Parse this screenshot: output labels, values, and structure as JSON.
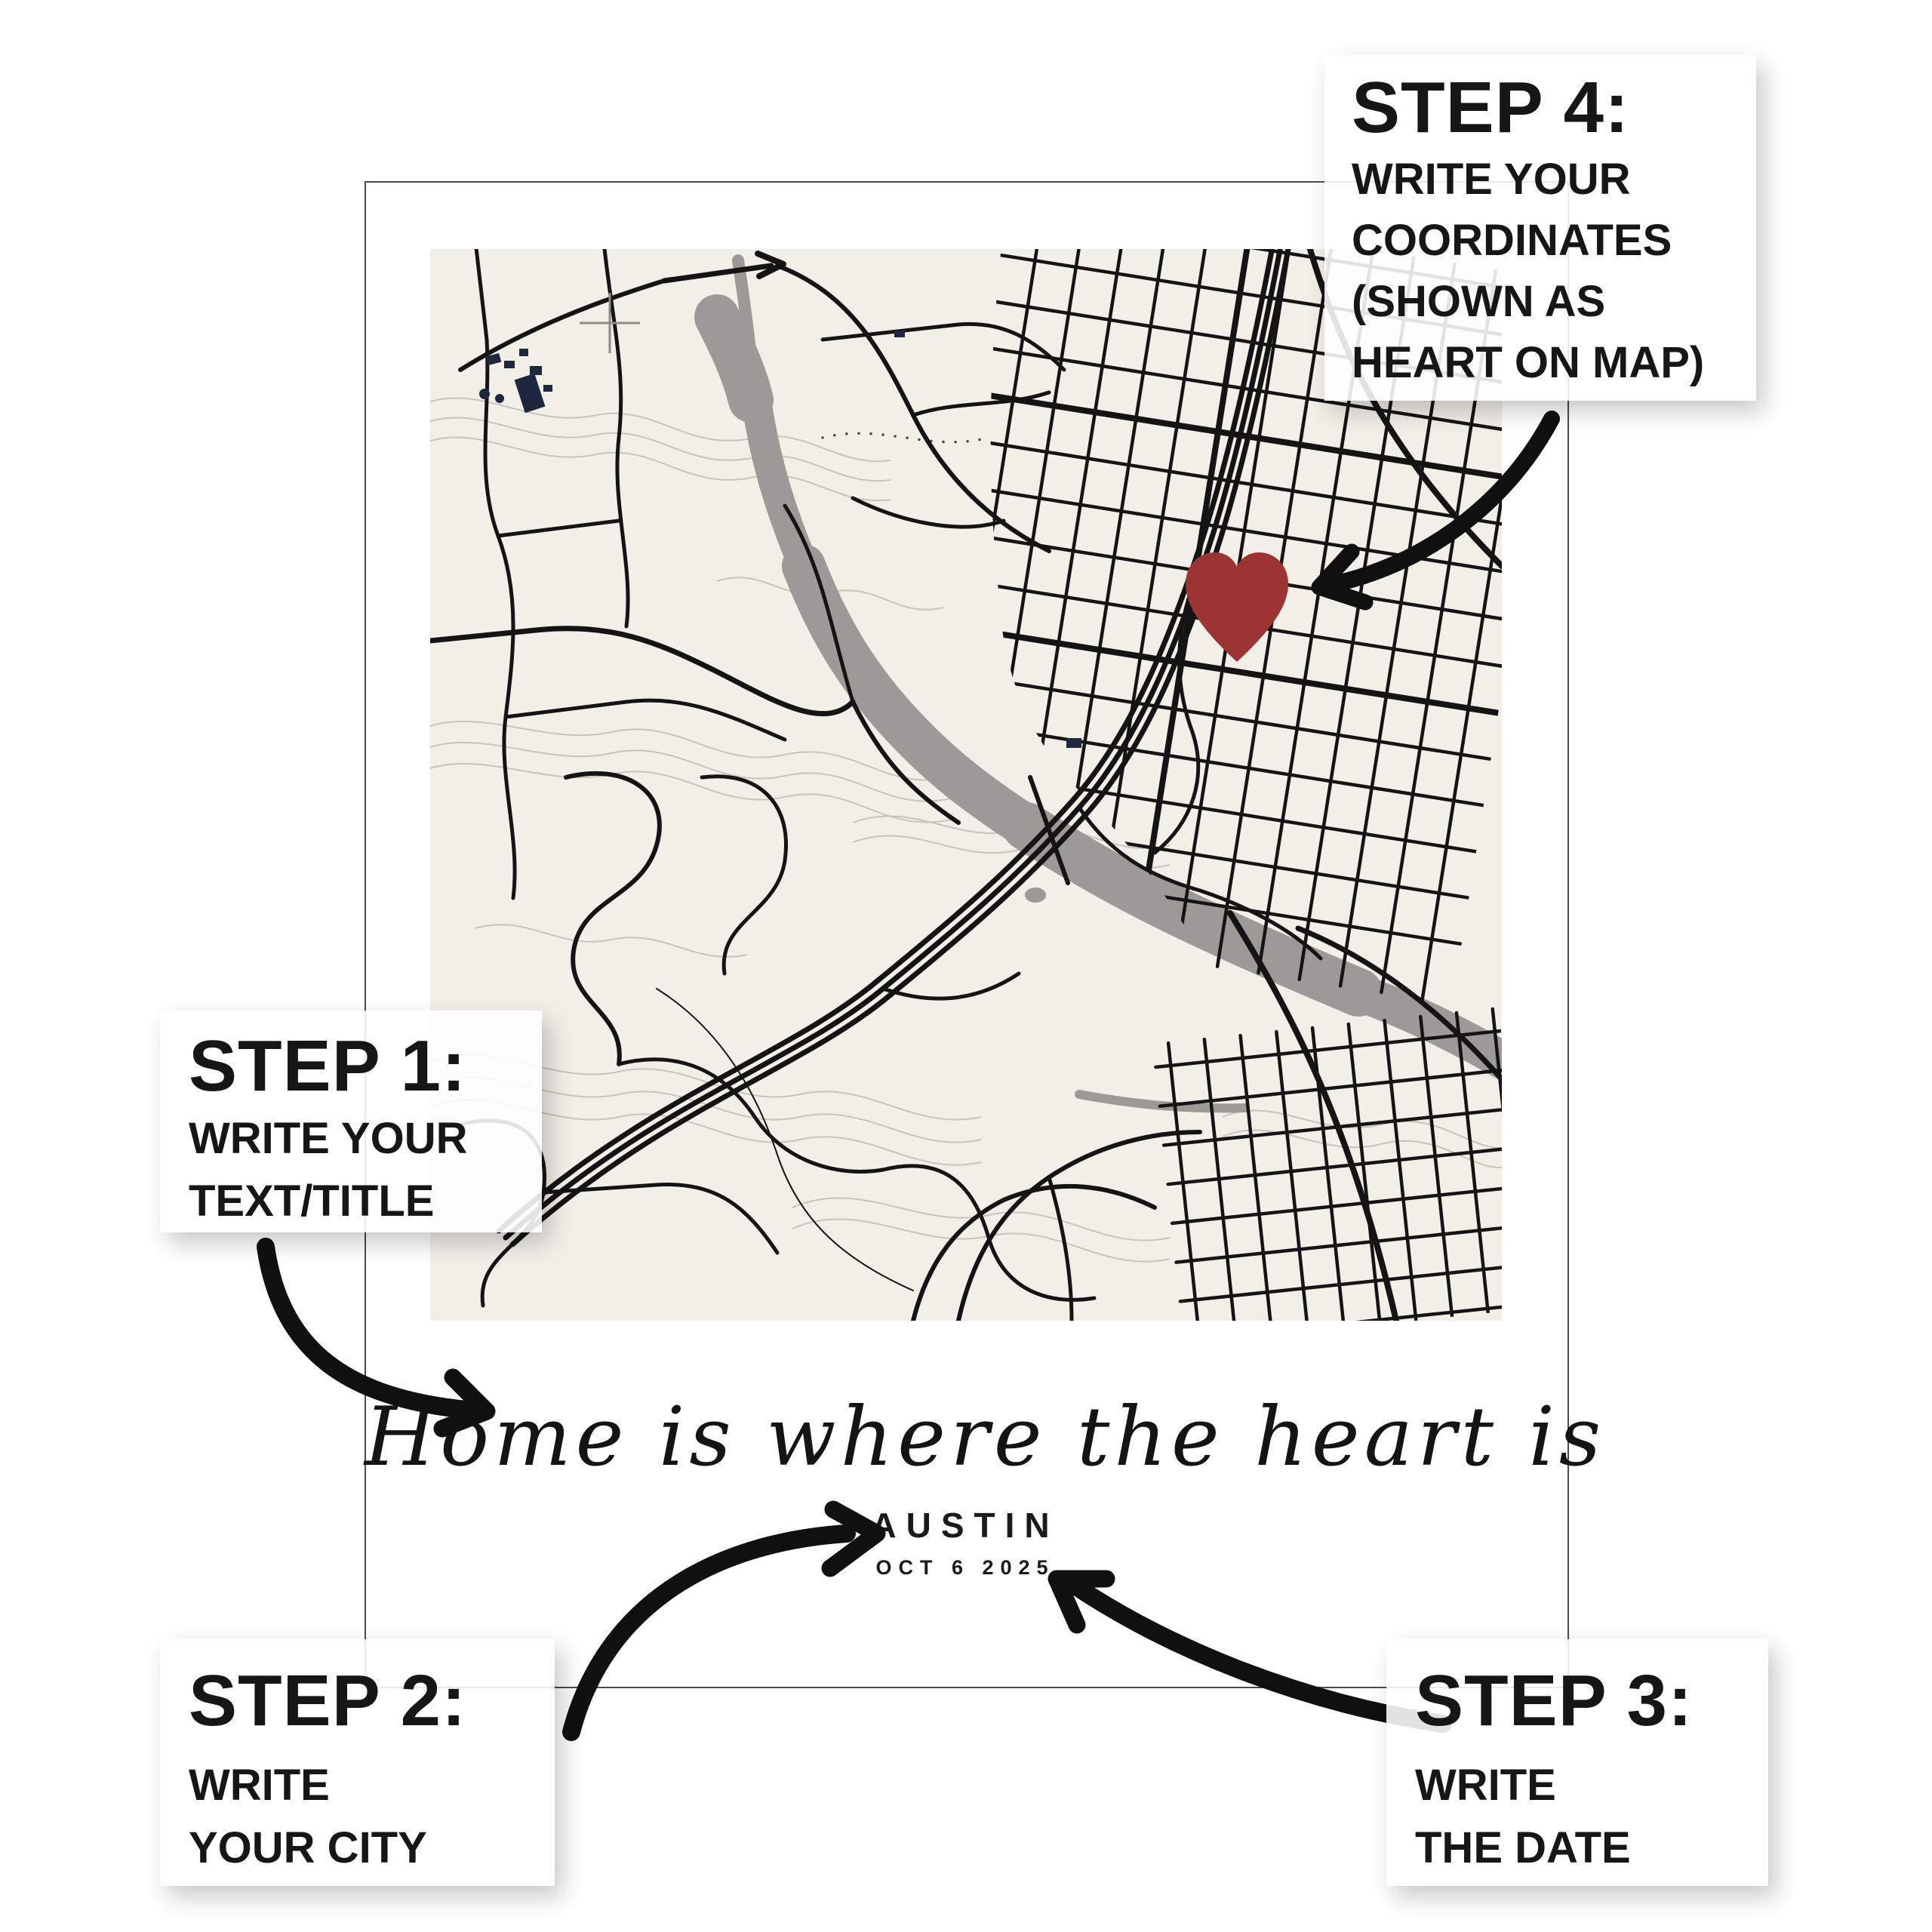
{
  "poster": {
    "title_script": "Home is where the heart is",
    "city": "AUSTIN",
    "date": "OCT 6 2025",
    "frame_color": "#4b4b4b",
    "text_color": "#1a1a1a"
  },
  "steps": [
    {
      "id": "step-1",
      "heading": "STEP 1:",
      "lines": [
        "WRITE YOUR",
        "TEXT/TITLE"
      ]
    },
    {
      "id": "step-2",
      "heading": "STEP 2:",
      "lines": [
        "WRITE",
        "YOUR CITY"
      ]
    },
    {
      "id": "step-3",
      "heading": "STEP 3:",
      "lines": [
        "WRITE",
        "THE DATE"
      ]
    },
    {
      "id": "step-4",
      "heading": "STEP 4:",
      "lines": [
        "WRITE YOUR",
        "COORDINATES",
        "(SHOWN AS",
        "HEART ON MAP)"
      ]
    }
  ],
  "map": {
    "city_depicted": "Austin",
    "heart_marker_color": "#9b3433",
    "background_color": "#f2efe8",
    "road_color": "#141414",
    "river_color": "#9c9a96",
    "contour_color": "#c8c4ba",
    "building_color": "#1d2840"
  },
  "annotations": {
    "arrow_color": "#101010"
  }
}
